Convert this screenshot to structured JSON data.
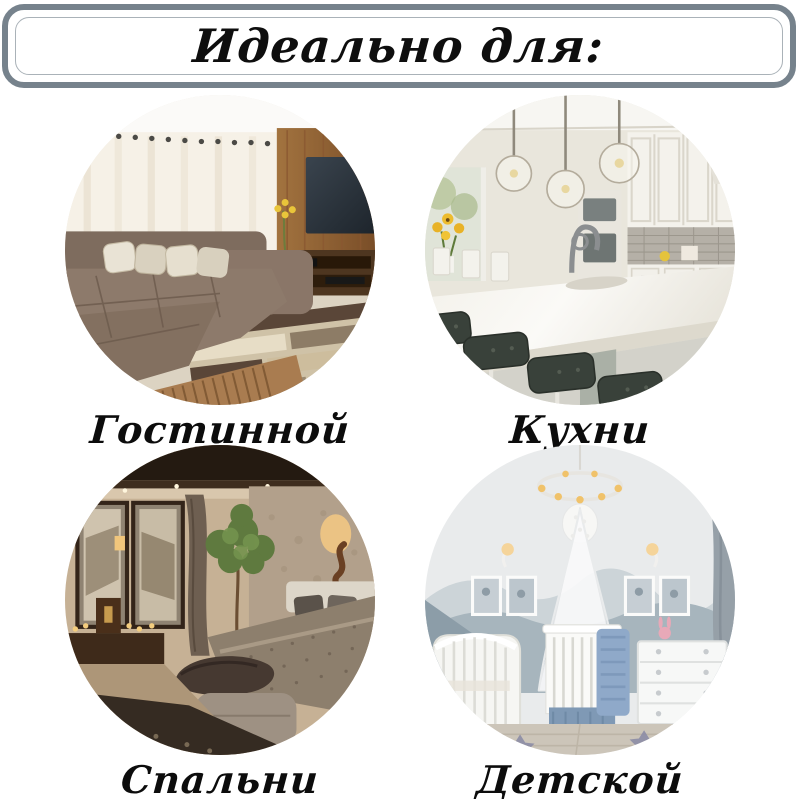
{
  "header": {
    "title": "Идеально для:"
  },
  "cards": [
    {
      "label": "Гостинной",
      "photo": "living-room-photo"
    },
    {
      "label": "Кухни",
      "photo": "kitchen-photo"
    },
    {
      "label": "Спальни",
      "photo": "bedroom-photo"
    },
    {
      "label": "Детской",
      "photo": "nursery-photo"
    }
  ],
  "colors": {
    "background": "#ffffff",
    "frame_border": "#76828c",
    "frame_inner_border": "#aab2b8",
    "title_text": "#0e0e0e",
    "caption_text": "#0c0c0c"
  }
}
